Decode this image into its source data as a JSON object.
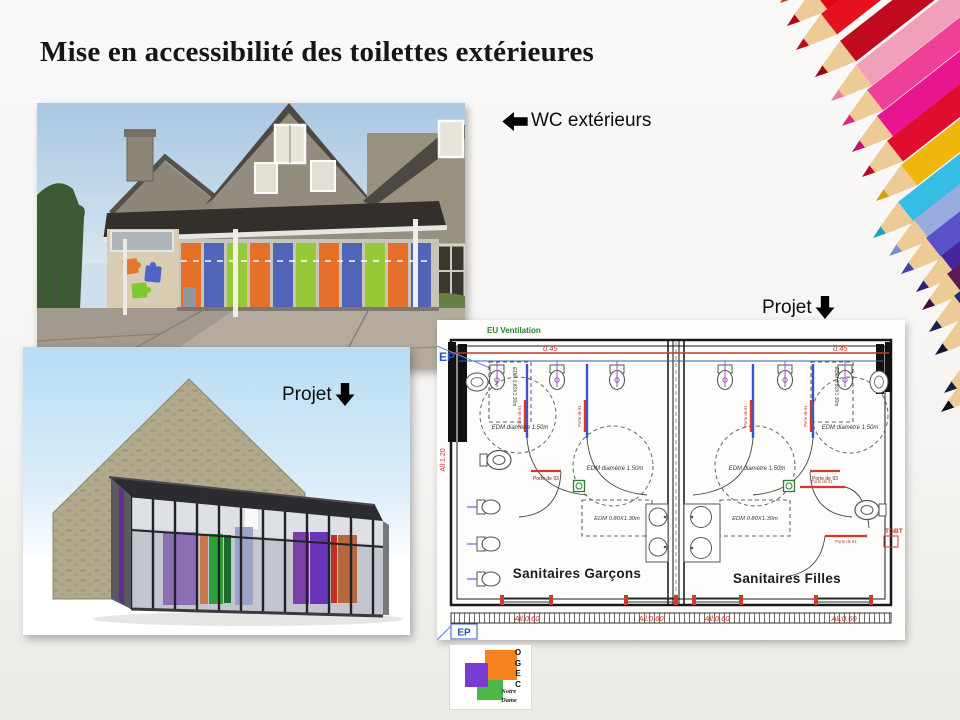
{
  "slide": {
    "title": "Mise en accessibilité des toilettes extérieures",
    "wc_label": "WC extérieurs",
    "projet_label_render": "Projet",
    "projet_label_plan": "Projet"
  },
  "plan": {
    "eu_ventilation": "EU Ventilation",
    "ep_top": "EP",
    "ep_bottom": "EP",
    "dim_top_left": "0.45",
    "dim_top_right": "0.45",
    "allege_left": "All:1.20",
    "allege_bottom": [
      "All:0.60",
      "All:0.60",
      "All:0.60",
      "All:0.60"
    ],
    "edm_circle_label": "EDM  diamètre  1.50m",
    "edm_rect_label": "EDM  0.80X1.30m",
    "door_93": "Porte de 93",
    "door_81": "Porte de 81",
    "tgbt": "TGBT",
    "room_boys": "Sanitaires Garçons",
    "room_girls": "Sanitaires Filles"
  },
  "logo": {
    "letters": [
      "O",
      "G",
      "E",
      "C"
    ],
    "name": [
      "Notre",
      "Dame"
    ]
  },
  "colors": {
    "door_orange": "#e4702a",
    "door_blue": "#5064b8",
    "door_green": "#96c838",
    "logo_orange": "#f5821f",
    "logo_purple": "#7a3bd0",
    "logo_green": "#4cb848",
    "plan_red": "#c0392b",
    "plan_blue": "#3a55c8",
    "plan_green": "#2e7d32",
    "pencils": [
      "#e84a0d",
      "#e20613",
      "#e5111f",
      "#c00a1d",
      "#f2a0ba",
      "#ee4097",
      "#e8168e",
      "#e00d2e",
      "#efb70c",
      "#36bde4",
      "#98abdf",
      "#5b51c8",
      "#46279b",
      "#5c1a52",
      "#1e2e6e",
      "#14204d",
      "#1a2a57",
      "#0f1833"
    ]
  }
}
